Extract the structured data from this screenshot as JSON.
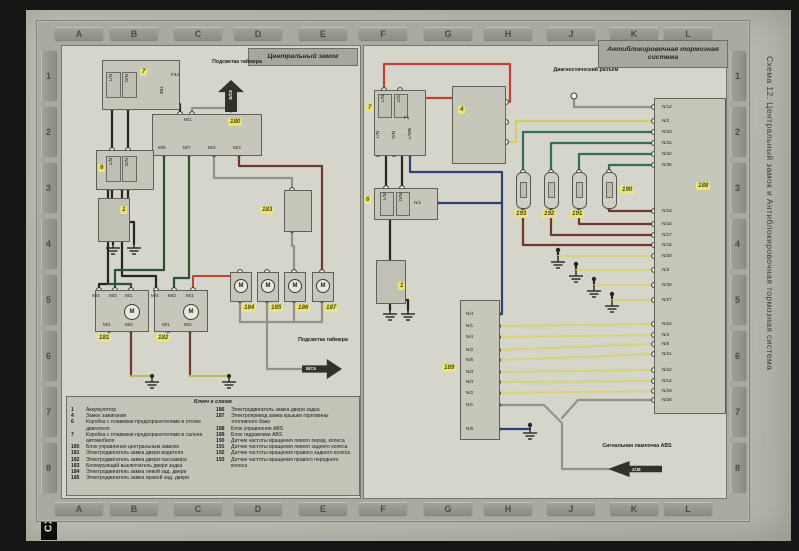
{
  "page": {
    "margin_title": "Схема 12. Центральный замок и Антиблокировочная тормозная система",
    "corner_label": "СХ",
    "grid_letters": [
      "A",
      "B",
      "C",
      "D",
      "E",
      "F",
      "G",
      "H",
      "J",
      "K",
      "L"
    ],
    "grid_numbers": [
      "1",
      "2",
      "3",
      "4",
      "5",
      "6",
      "7",
      "8"
    ]
  },
  "symbols": {
    "motor": "M"
  },
  "left": {
    "title": "Центральный замок",
    "timer_top": {
      "label": "Подсветка таймера",
      "arrow": "В/С6"
    },
    "timer_bottom": {
      "label": "Подсветка таймера",
      "arrow": "В/С6"
    },
    "fusebox7": {
      "id": "7",
      "fuse": "F34",
      "pins": [
        "L/N",
        "D/N"
      ],
      "pin_out": "ЗВ1"
    },
    "fusebox6": {
      "id": "6",
      "pins": [
        "L/N",
        "D/N"
      ]
    },
    "battery": {
      "id": "1"
    },
    "unit180": {
      "id": "180",
      "pin_top": "M/1",
      "pins": [
        "M/5",
        "M/7",
        "M/4",
        "M/3"
      ]
    },
    "switch183": {
      "id": "183"
    },
    "motor181": {
      "id": "181",
      "pins_top": [
        "M/4",
        "M/3",
        "M/1"
      ],
      "pins_bottom": [
        "M/1",
        "M/2"
      ]
    },
    "motor182": {
      "id": "182",
      "pins_top": [
        "M/4",
        "M/3",
        "M/1"
      ],
      "pins_bottom": [
        "M/1",
        "M/2"
      ]
    },
    "motors": [
      "184",
      "185",
      "186",
      "187"
    ]
  },
  "right": {
    "title": "Антиблокировочная тормозная система",
    "diag_label": "Диагностический разъем",
    "fusebox7": {
      "id": "7",
      "pins_top": [
        "L/N",
        "L/G"
      ],
      "fuse": "F1",
      "pins_bottom": [
        "L/N",
        "D/N",
        "L/WB"
      ]
    },
    "ignition4": {
      "id": "4"
    },
    "fusebox6": {
      "id": "6",
      "pins": [
        "L/N",
        "D/N"
      ],
      "pin_out": "N/1"
    },
    "battery": {
      "id": "1"
    },
    "ecu188": {
      "id": "188",
      "pins_g1": [
        "N/12",
        "N/2",
        "N/33",
        "N/34",
        "N/32",
        "N/35"
      ],
      "pins_g2": [
        "N/18",
        "N/15",
        "N/17",
        "N/16",
        "N/20",
        "N/3",
        "N/28",
        "N/27"
      ],
      "pins_g3": [
        "N/24",
        "N/4",
        "N/5",
        "N/21",
        "N/22",
        "N/14",
        "N/19",
        "N/26"
      ]
    },
    "hydraulic189": {
      "id": "189",
      "pins": [
        "N/4",
        "N/1",
        "N/4",
        "N/2",
        "N/5",
        "N/3",
        "N/3",
        "N/2",
        "N/1",
        "N/5"
      ]
    },
    "sensors": [
      "193",
      "192",
      "191",
      "190"
    ],
    "lamp": {
      "label": "Сигнальная лампочка ABS",
      "arrow": "3/J8"
    }
  },
  "legend": {
    "title": "Ключ к схеме",
    "left": [
      {
        "num": "1",
        "text": "Аккумулятор"
      },
      {
        "num": "4",
        "text": "Замок зажигания"
      },
      {
        "num": "6",
        "text": "Коробка с плавкими предохранителями в отсеке двигателя"
      },
      {
        "num": "7",
        "text": "Коробка с плавкими предохранителями в салоне автомобиля"
      },
      {
        "num": "180",
        "text": "Блок управления центральным замком"
      },
      {
        "num": "181",
        "text": "Электродвигатель замка двери водителя"
      },
      {
        "num": "182",
        "text": "Электродвигатель замка двери пассажира"
      },
      {
        "num": "183",
        "text": "Блокирующий выключатель двери задка"
      },
      {
        "num": "184",
        "text": "Электродвигатель замка левой зад. двери"
      },
      {
        "num": "185",
        "text": "Электродвигатель замка правой зад. двери"
      }
    ],
    "right": [
      {
        "num": "186",
        "text": "Электродвигатель замка двери задка"
      },
      {
        "num": "187",
        "text": "Электропривод замка крышки горловины топливного бака"
      },
      {
        "num": "188",
        "text": "Блок управления ABS"
      },
      {
        "num": "189",
        "text": "Блок гидравлики ABS"
      },
      {
        "num": "190",
        "text": "Датчик частоты вращения левого перед. колеса"
      },
      {
        "num": "191",
        "text": "Датчик частоты вращения левого заднего колеса"
      },
      {
        "num": "192",
        "text": "Датчик частоты вращения правого заднего колеса"
      },
      {
        "num": "193",
        "text": "Датчик частоты вращения правого переднего колеса"
      }
    ]
  },
  "colors": {
    "wire_black": "#26261f",
    "wire_green": "#2a5232",
    "wire_teal": "#31705a",
    "wire_brown": "#6e382c",
    "wire_red": "#c14134",
    "wire_blue": "#30407c",
    "wire_yellow": "#d4cc68",
    "wire_gray": "#92928a",
    "badge_yellow": "#e9e47f"
  }
}
